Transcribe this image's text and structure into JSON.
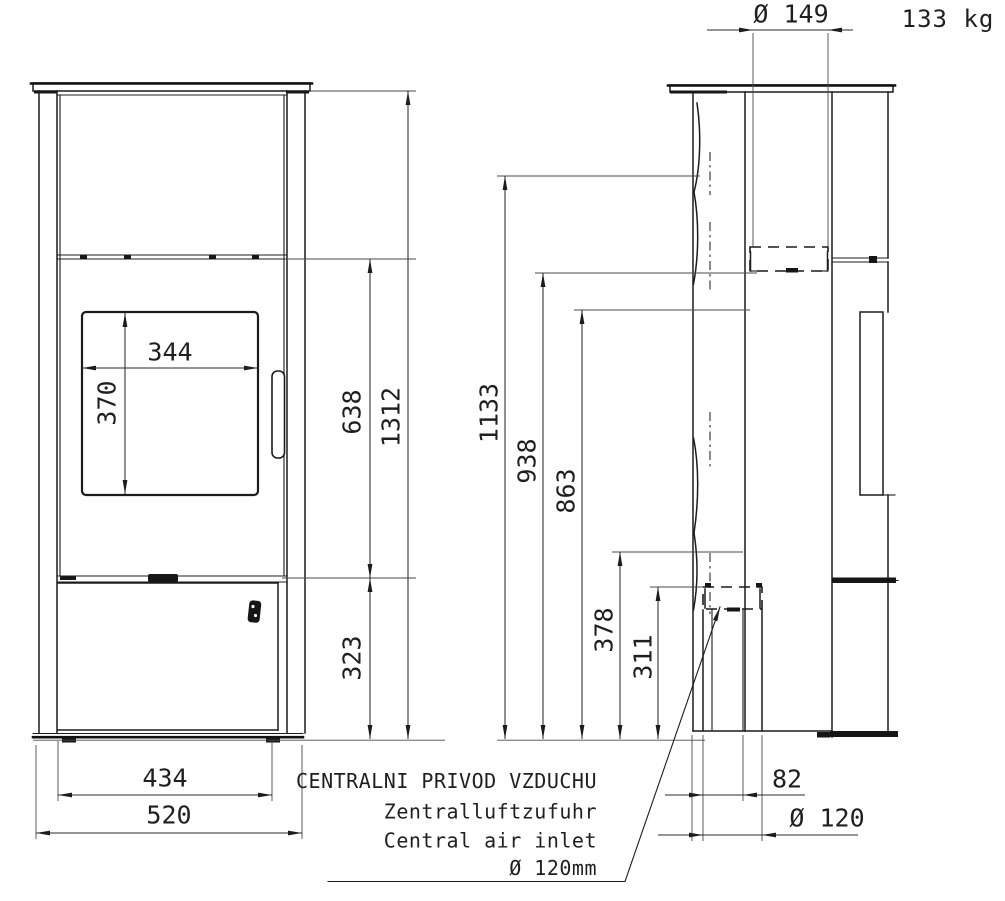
{
  "drawing": {
    "background": "#ffffff",
    "line_color": "#1c1c1c",
    "weight": "133 kg",
    "dimensions": {
      "flue_collar_diameter": "Ø 149",
      "overall_height": "1312",
      "firebox_top_height": "638",
      "base_height": "323",
      "glass_width": "344",
      "glass_height": "370",
      "inner_width": "434",
      "overall_width": "520",
      "flue_axis_height": "1133",
      "rear_outlet_height": "938",
      "side_panel_height": "863",
      "inlet_top_height": "378",
      "inlet_axis_height": "311",
      "inlet_rear_offset": "82",
      "inlet_pipe_diameter": "Ø 120"
    },
    "air_inlet_note": {
      "cs": "CENTRALNI PRIVOD VZDUCHU",
      "de": "Zentralluftzufuhr",
      "en": "Central air inlet",
      "size": "Ø 120mm"
    }
  }
}
